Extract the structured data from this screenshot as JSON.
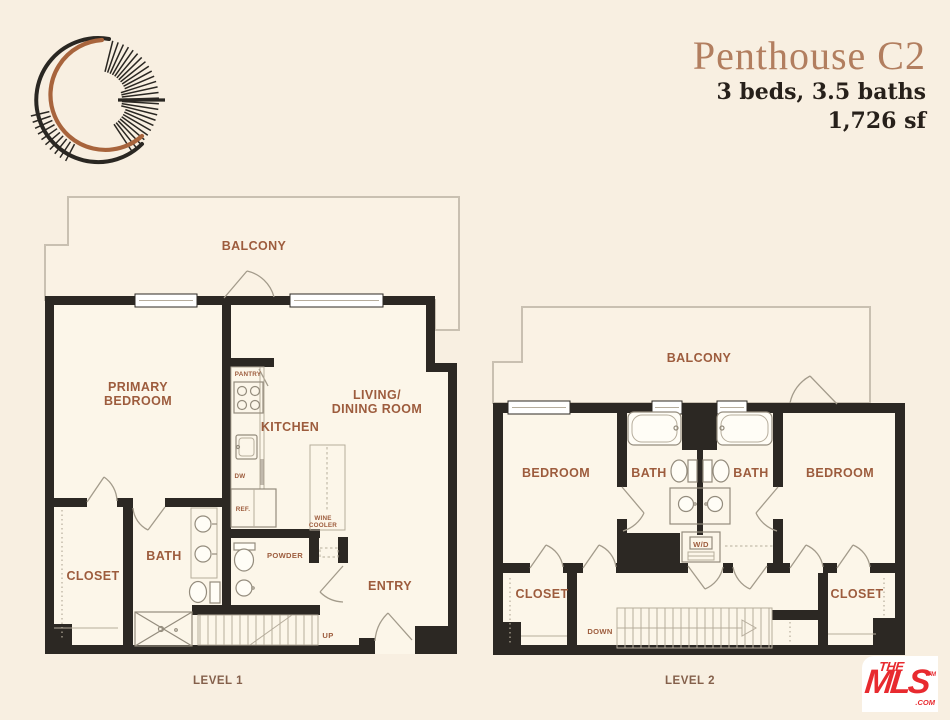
{
  "header": {
    "title": "Penthouse C2",
    "specs": "3 beds, 3.5 baths",
    "area": "1,726 sf"
  },
  "brand": {
    "logo_icon": "crescent-moon-logo"
  },
  "level1": {
    "caption": "LEVEL 1",
    "rooms": {
      "balcony": "BALCONY",
      "primary_bedroom": [
        "PRIMARY",
        "BEDROOM"
      ],
      "living_dining": [
        "LIVING/",
        "DINING ROOM"
      ],
      "kitchen": "KITCHEN",
      "pantry": "PANTRY",
      "dw": "DW",
      "ref": "REF.",
      "wine_cooler": [
        "WINE",
        "COOLER"
      ],
      "bath": "BATH",
      "closet": "CLOSET",
      "powder": "POWDER",
      "entry": "ENTRY",
      "up": "UP"
    }
  },
  "level2": {
    "caption": "LEVEL 2",
    "rooms": {
      "balcony": "BALCONY",
      "bedroom_left": "BEDROOM",
      "bath_left": "BATH",
      "bath_right": "BATH",
      "bedroom_right": "BEDROOM",
      "wd": "W/D",
      "closet_left": "CLOSET",
      "closet_right": "CLOSET",
      "down": "DOWN"
    }
  },
  "watermark": {
    "the": "THE",
    "mls": "MLS",
    "com": ".COM",
    "tm": "TM"
  },
  "colors": {
    "background": "#f8efe1",
    "wall": "#2c2823",
    "room_label": "#9d5c3d",
    "title": "#b27e5f",
    "dark_text": "#27201a",
    "mls_red": "#e82a2f"
  }
}
